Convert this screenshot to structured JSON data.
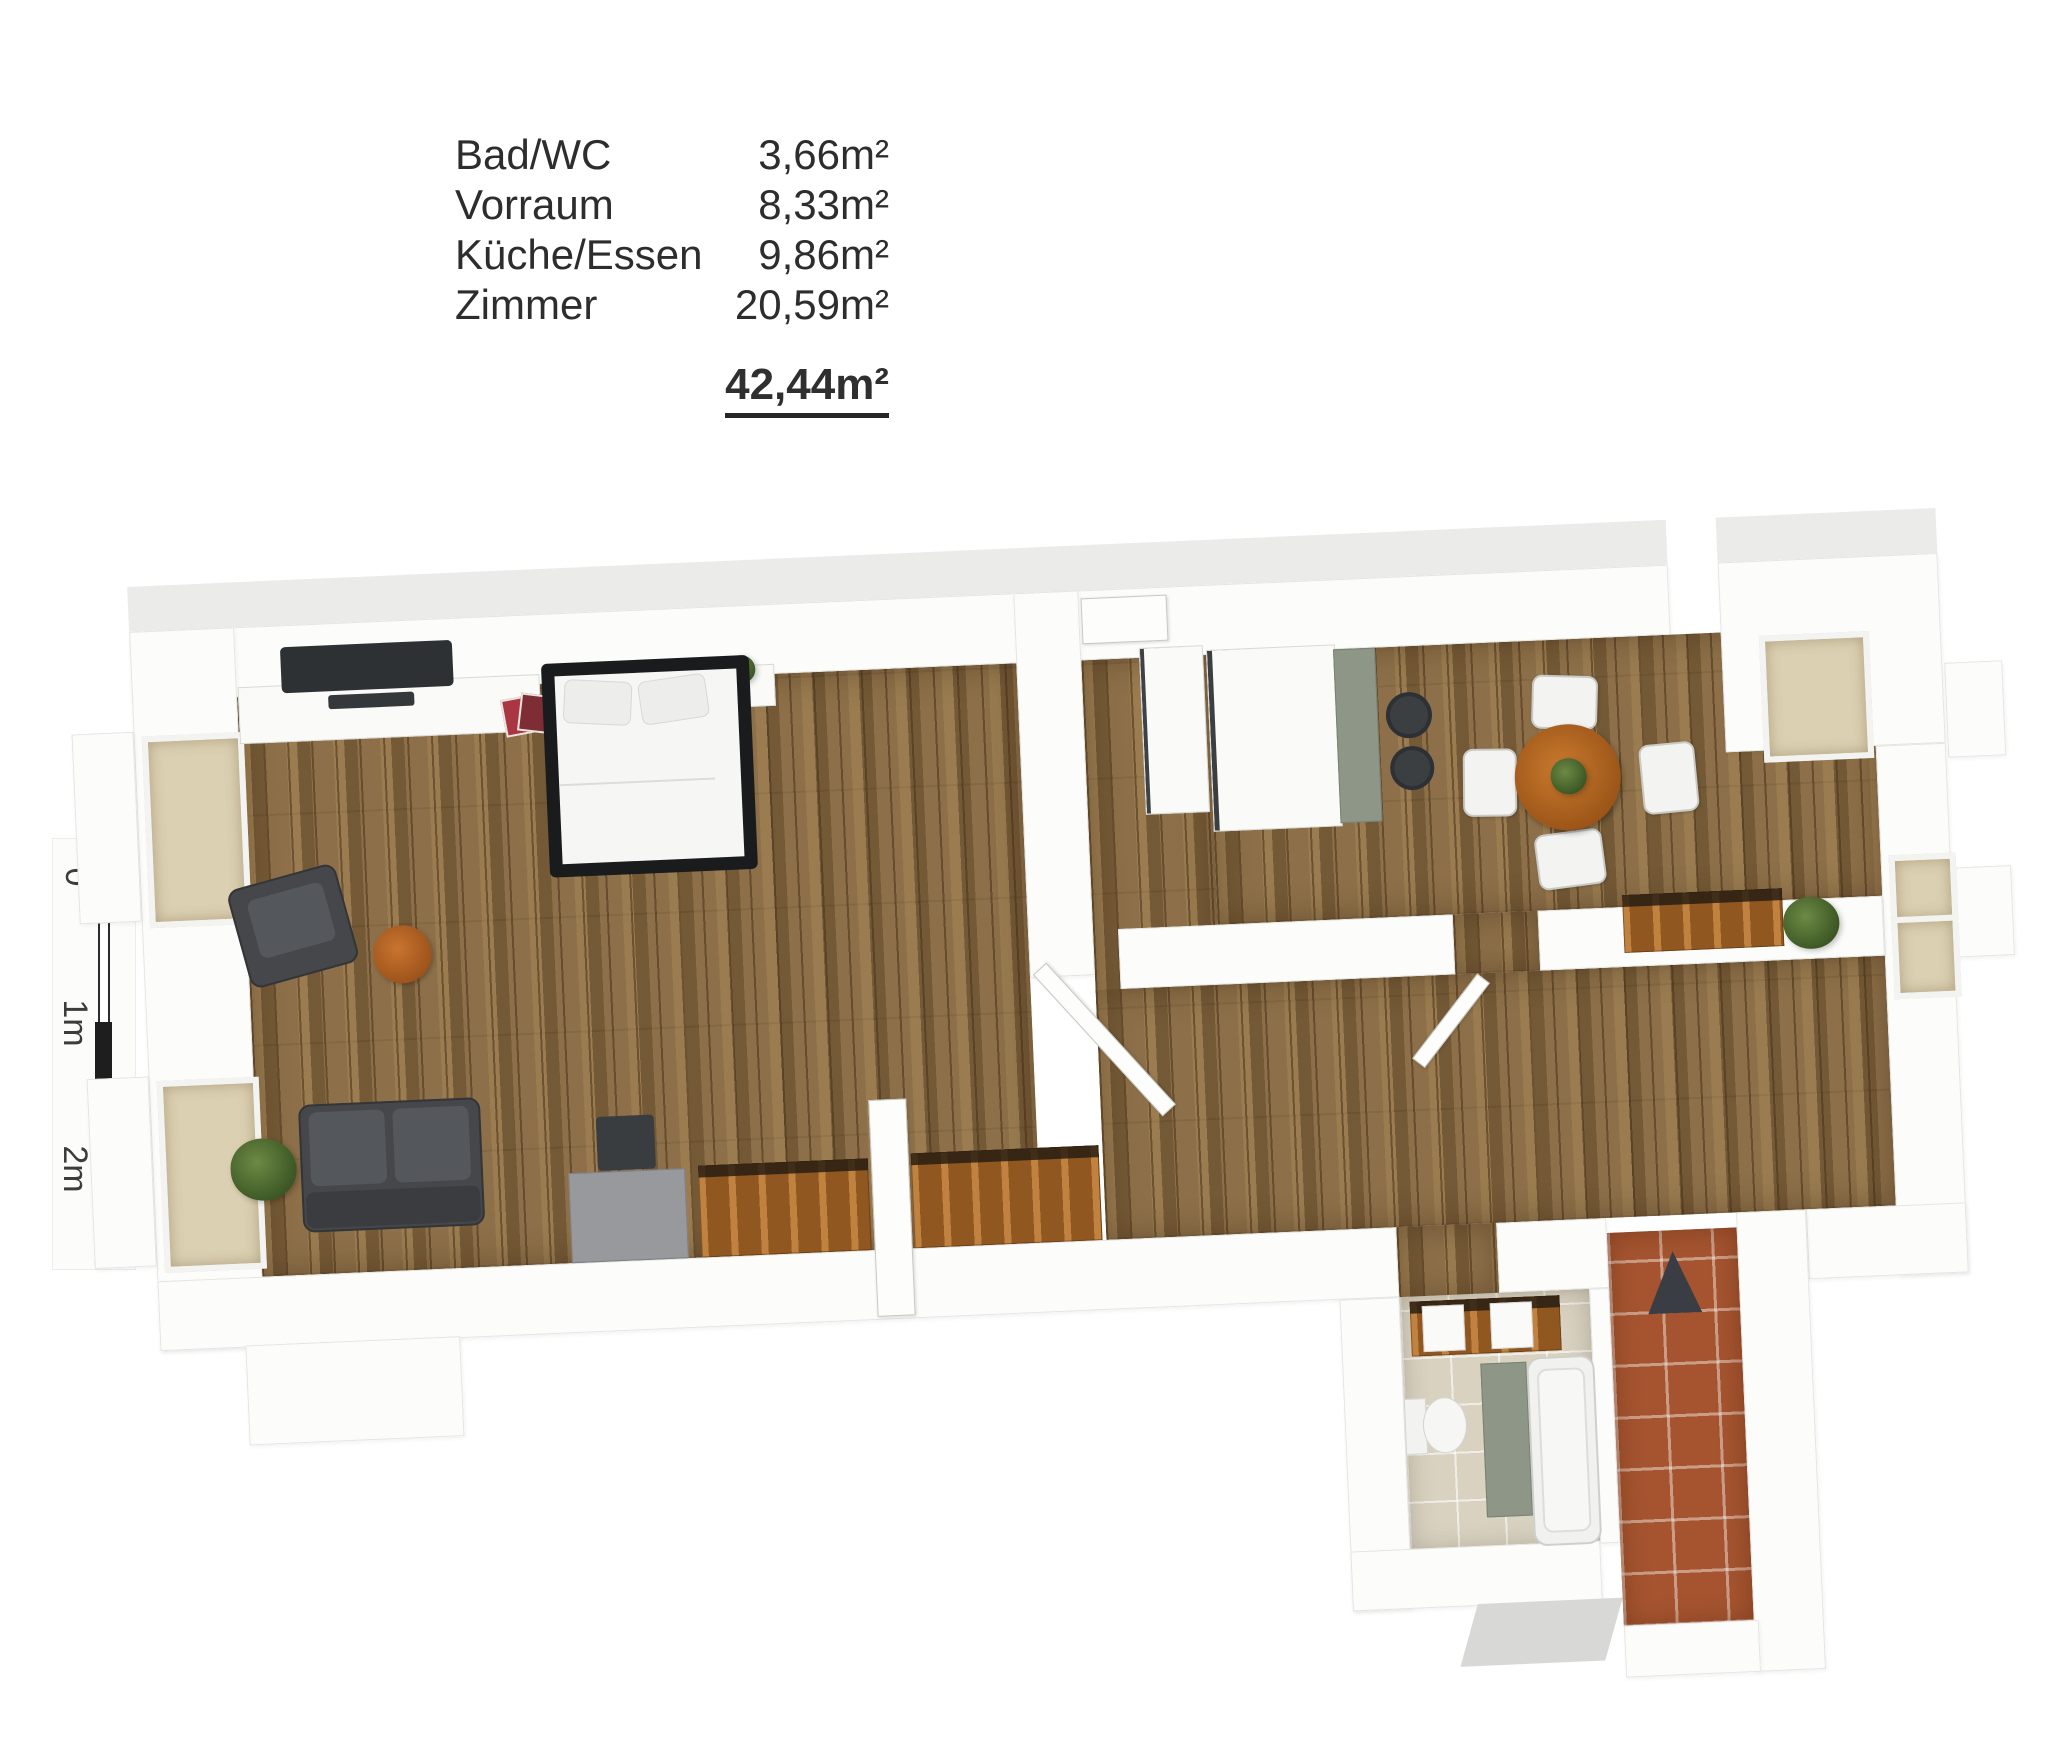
{
  "legend": {
    "rows": [
      {
        "label": "Bad/WC",
        "value": "3,66m²"
      },
      {
        "label": "Vorraum",
        "value": "8,33m²"
      },
      {
        "label": "Küche/Essen",
        "value": "9,86m²"
      },
      {
        "label": "Zimmer",
        "value": "20,59m²"
      }
    ],
    "total_value": "42,44m²"
  },
  "scale_bar": {
    "labels": [
      "0",
      "1m",
      "2m"
    ]
  },
  "colors": {
    "wood_floor": "#87683f",
    "furniture_wood": "#a96526",
    "upholstery_gray": "#45474a",
    "kitchen_sage": "#8d9687",
    "bath_tile_beige": "#d9d2c1",
    "stair_tile_terracotta": "#a5542f",
    "wall_white": "#fcfcfb",
    "window_glow": "#dbd0b2",
    "text": "#2d2d2d"
  }
}
